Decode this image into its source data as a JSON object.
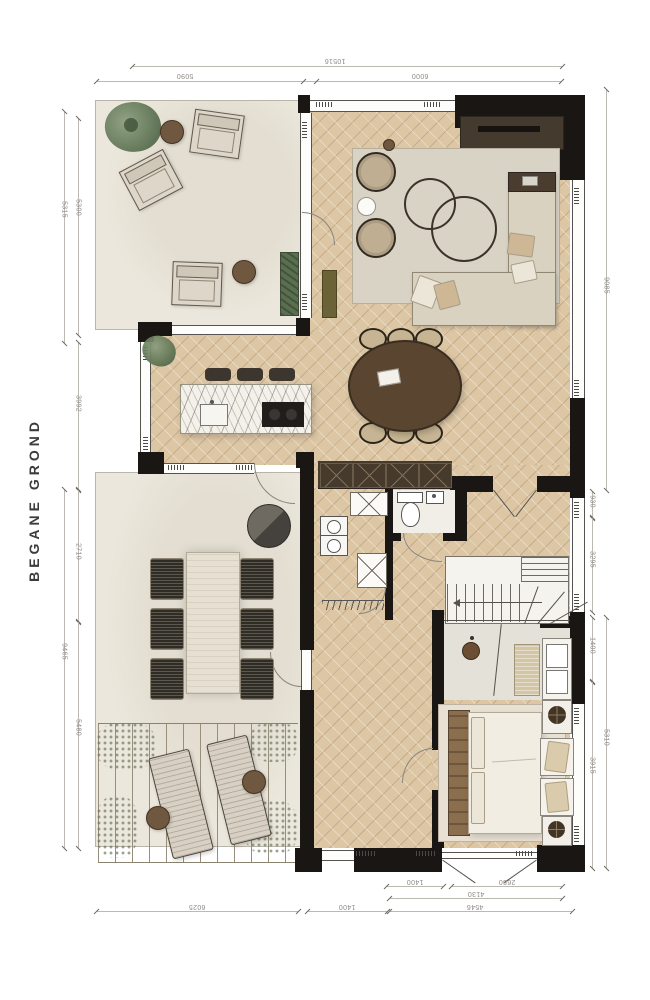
{
  "title": "BEGANE GROND",
  "dimensions": {
    "top_outer": "10516",
    "top": [
      "5090",
      "6000"
    ],
    "left_outer": [
      "5315",
      "9465"
    ],
    "left_inner": [
      "5300",
      "3992",
      "2710",
      "5480"
    ],
    "right_outer": [
      "9085",
      "5310"
    ],
    "right_inner": [
      "930",
      "3295",
      "1400",
      "3915"
    ],
    "bottom_row1": [
      "1400",
      "2680"
    ],
    "bottom_row2": [
      "4130"
    ],
    "bottom_row3": [
      "6025",
      "1400",
      "4546"
    ]
  },
  "colors": {
    "wall": "#1a1613",
    "wood_floor": "#dcc6a4",
    "terrace": "#ebe7dc",
    "rug": "#d9d3c5",
    "dark_wood": "#5a4531",
    "marble": "#f4f1ea",
    "greenery": "#5d7251",
    "dimension_text": "#8d8a84"
  }
}
